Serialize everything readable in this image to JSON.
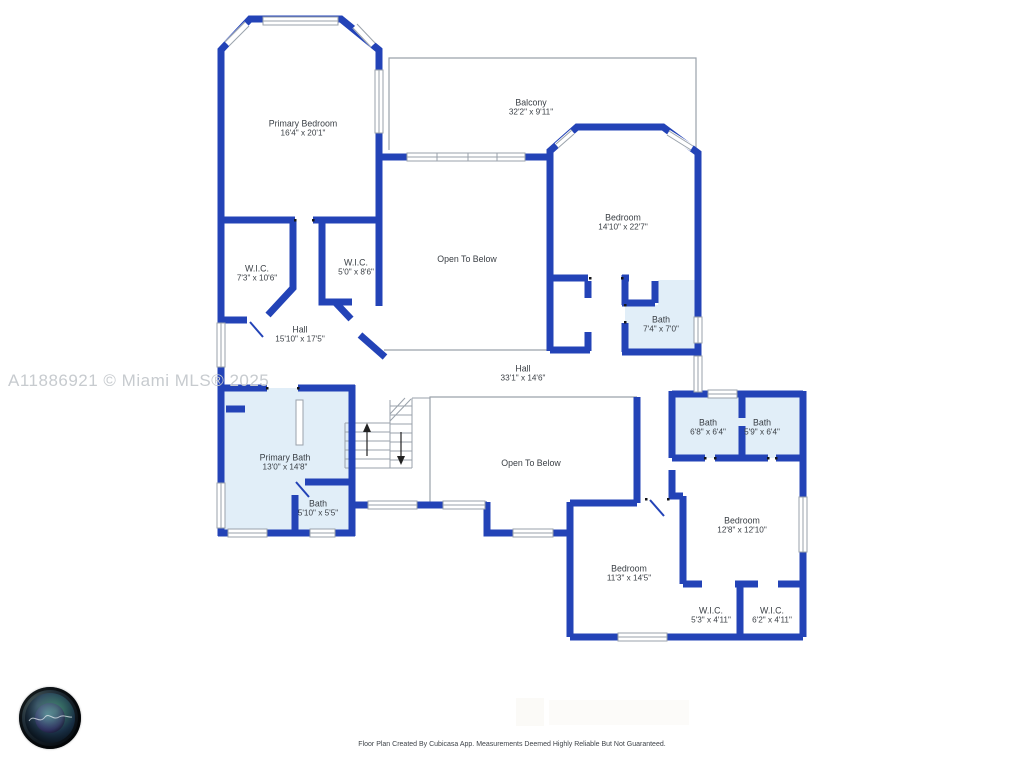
{
  "watermark": {
    "text": "A11886921 © Miami MLS® 2025"
  },
  "footer": {
    "disclaimer": "Floor Plan Created By Cubicasa App. Measurements Deemed Highly Reliable But Not Guaranteed."
  },
  "logo": {
    "name": "camera-lens-logo"
  },
  "colors": {
    "wall": "#2343b7",
    "bath_fill": "#e1eef8",
    "thin_line": "#9aa2ab",
    "label_text": "#3a3f45",
    "watermark_text": "#c7cbcf"
  },
  "rooms": [
    {
      "name": "Primary Bedroom",
      "dims": "16'4\" x 20'1\""
    },
    {
      "name": "Balcony",
      "dims": "32'2\" x 9'11\""
    },
    {
      "name": "Bedroom",
      "dims": "14'10\" x 22'7\""
    },
    {
      "name": "Open To Below",
      "dims": ""
    },
    {
      "name": "W.I.C.",
      "dims": "7'3\" x 10'6\""
    },
    {
      "name": "W.I.C.",
      "dims": "5'0\" x 8'6\""
    },
    {
      "name": "Hall",
      "dims": "15'10\" x 17'5\""
    },
    {
      "name": "Bath",
      "dims": "7'4\" x 7'0\""
    },
    {
      "name": "Hall",
      "dims": "33'1\" x 14'6\""
    },
    {
      "name": "Open To Below",
      "dims": ""
    },
    {
      "name": "Primary Bath",
      "dims": "13'0\" x 14'8\""
    },
    {
      "name": "Bath",
      "dims": "5'10\" x 5'5\""
    },
    {
      "name": "Bath",
      "dims": "6'8\" x 6'4\""
    },
    {
      "name": "Bath",
      "dims": "5'9\" x 6'4\""
    },
    {
      "name": "Bedroom",
      "dims": "12'8\" x 12'10\""
    },
    {
      "name": "Bedroom",
      "dims": "11'3\" x 14'5\""
    },
    {
      "name": "W.I.C.",
      "dims": "5'3\" x 4'11\""
    },
    {
      "name": "W.I.C.",
      "dims": "6'2\" x 4'11\""
    }
  ]
}
